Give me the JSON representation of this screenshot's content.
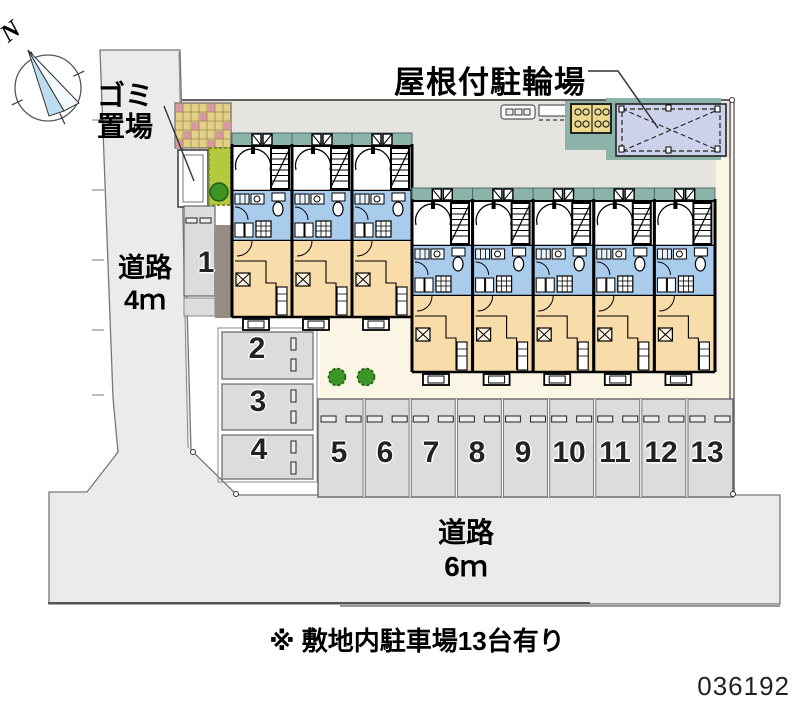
{
  "compass": {
    "north_label": "N"
  },
  "annotations": {
    "garbage_line1": "ゴミ",
    "garbage_line2": "置場",
    "bicycle_label": "屋根付駐輪場",
    "note": "※ 敷地内駐車場13台有り"
  },
  "roads": {
    "left": {
      "name": "道路",
      "width": "4ｍ"
    },
    "bottom": {
      "name": "道路",
      "width": "6ｍ"
    }
  },
  "parking": {
    "stalls": [
      {
        "label": "1"
      },
      {
        "label": "2"
      },
      {
        "label": "3"
      },
      {
        "label": "4"
      },
      {
        "label": "5"
      },
      {
        "label": "6"
      },
      {
        "label": "7"
      },
      {
        "label": "8"
      },
      {
        "label": "9"
      },
      {
        "label": "10"
      },
      {
        "label": "11"
      },
      {
        "label": "12"
      },
      {
        "label": "13"
      }
    ]
  },
  "meta": {
    "plan_id": "036192"
  },
  "colors": {
    "teal": "#8cb3a9",
    "blue": "#a9cbec",
    "orange": "#f8dcaa",
    "lavender": "#cdd2ea",
    "road": "#ebebeb",
    "stall": "#dcdcde",
    "strip": "#e6e4df",
    "cream": "#fbf5e6",
    "hedge": "#b5c93e",
    "bush": "#3c9627",
    "brick_base": "#e3cf85",
    "brick_pink": "#d898a0",
    "tan_box": "#ecd98b",
    "dark_strip": "#968c83",
    "wall": "#0a0a0a"
  }
}
